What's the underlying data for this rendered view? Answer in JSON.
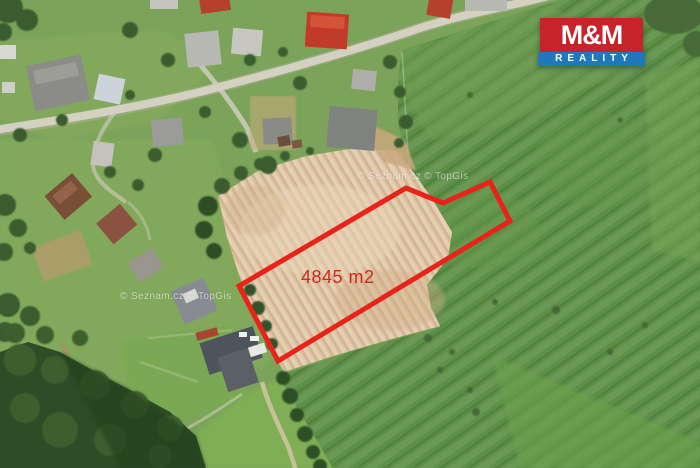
{
  "map": {
    "area_label": "4845 m2",
    "watermark_top": "© Seznam.cz © TopGis",
    "watermark_bottom": "© Seznam.cz © TopGis",
    "plot_outline": {
      "points": "239,286 406,188 443,203 490,182 510,221 278,361",
      "color": "#e8231a"
    }
  },
  "logo": {
    "name": "M&M",
    "subtitle": "REALITY",
    "red": "#c5242b",
    "blue": "#2078ba"
  }
}
